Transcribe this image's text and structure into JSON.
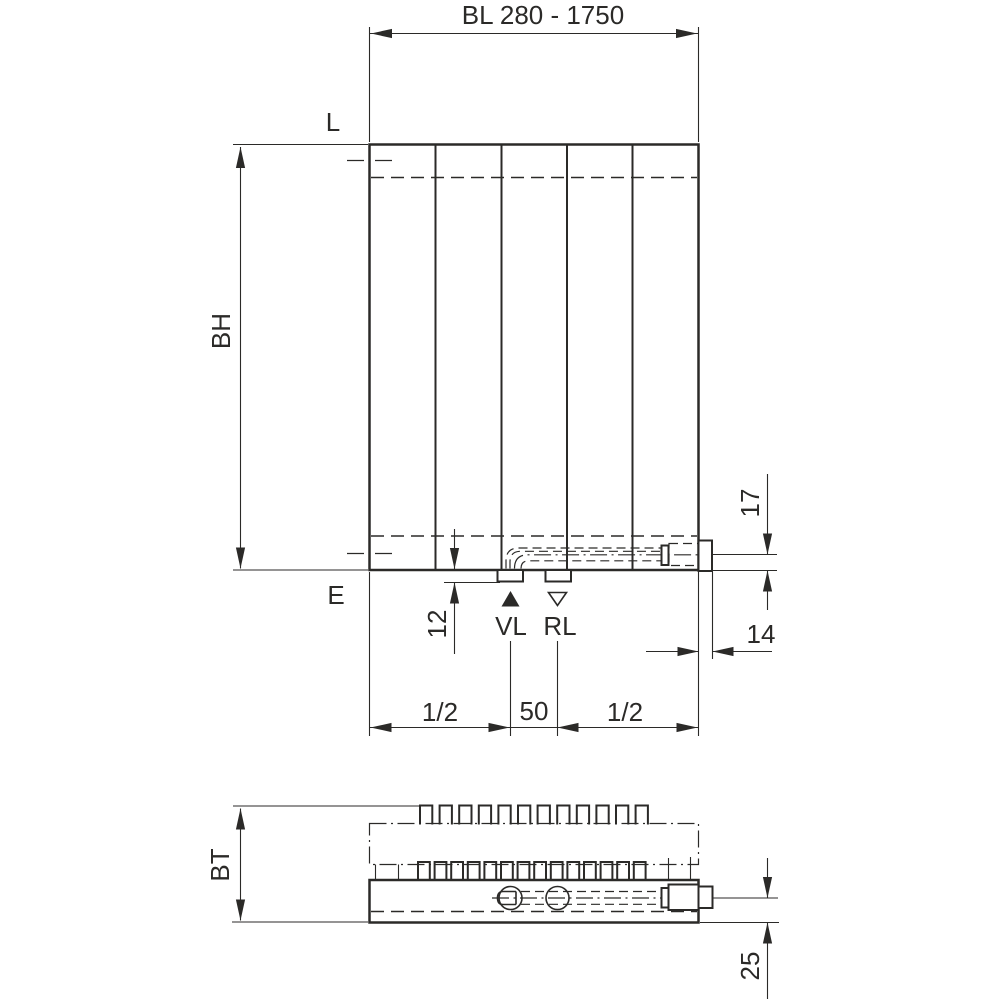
{
  "drawing": {
    "ink_color": "#2b2a28",
    "front_view": {
      "length_dim_label": "BL 280 - 1750",
      "height_dim_label": "BH",
      "vent_label": "L",
      "drain_label": "E",
      "supply_label": "VL",
      "return_label": "RL",
      "dim_12": "12",
      "dim_17": "17",
      "dim_14": "14",
      "span_left": "1/2",
      "span_center": "50",
      "span_right": "1/2"
    },
    "bottom_view": {
      "depth_dim_label": "BT",
      "dim_25": "25"
    }
  }
}
